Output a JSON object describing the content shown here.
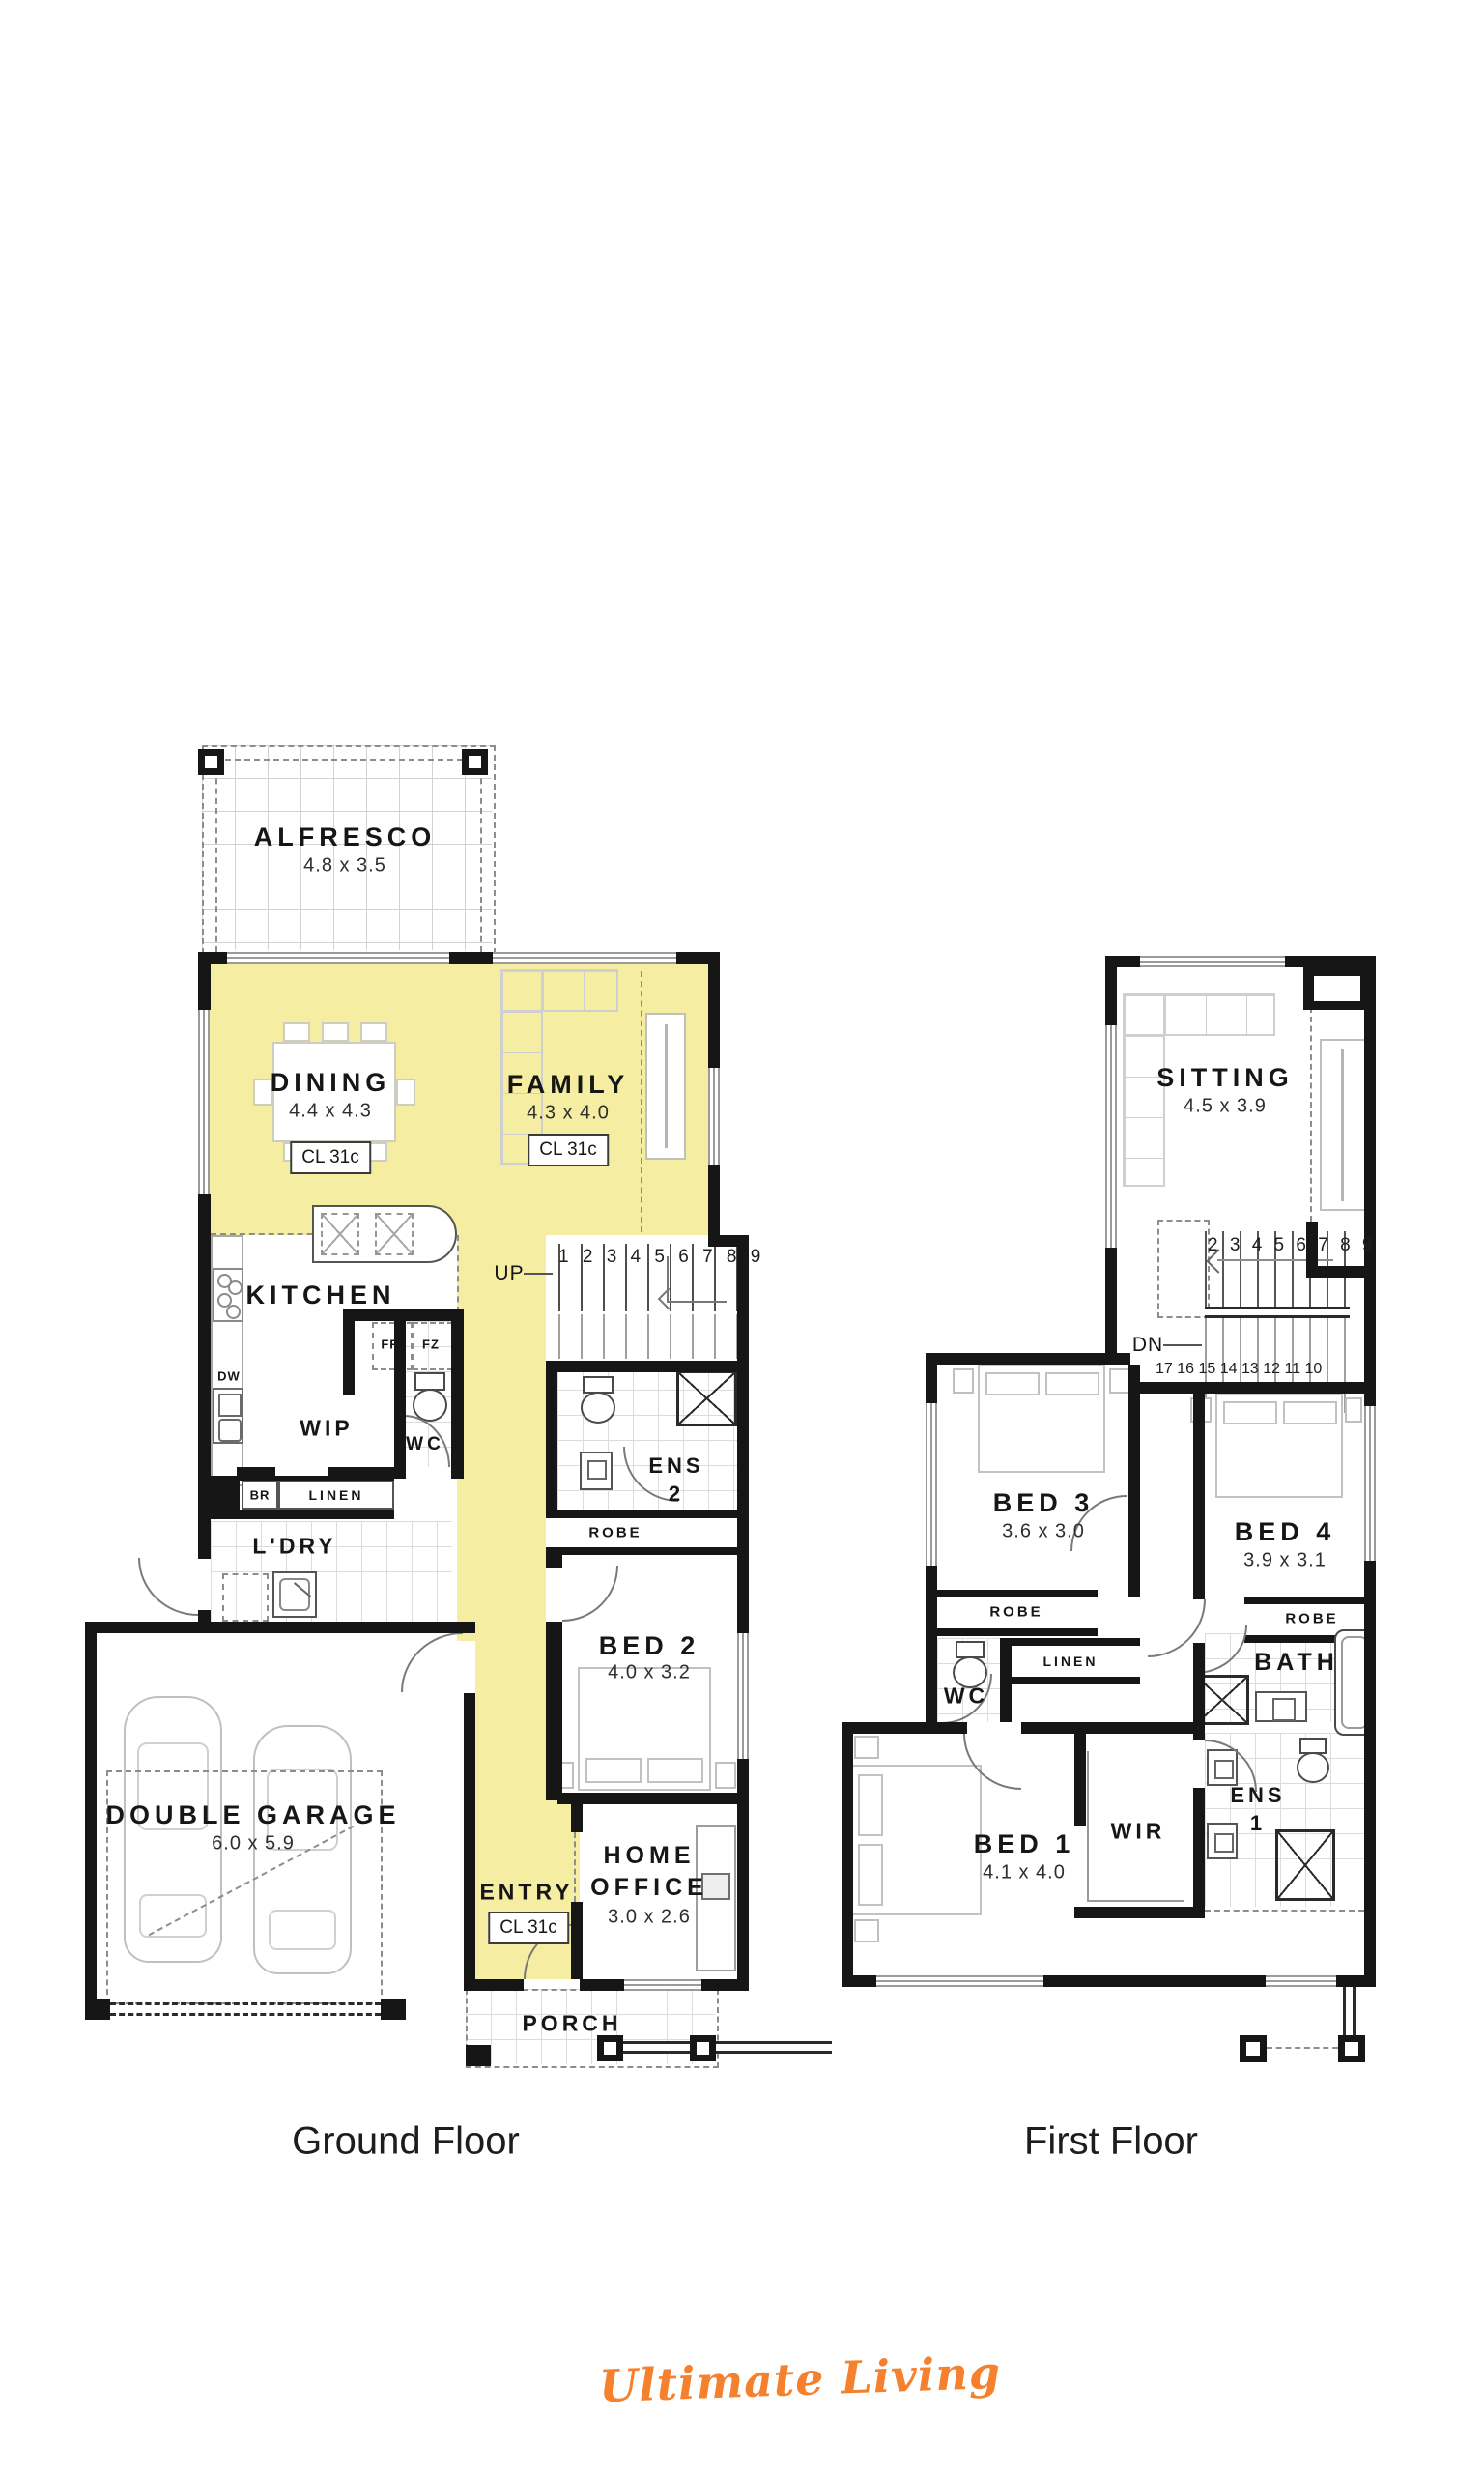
{
  "colors": {
    "highlight": "#F5EDA1",
    "accent_orange": "#F5812F",
    "wall": "#161616"
  },
  "brand": "Ultimate Living",
  "gf": {
    "caption": "Ground Floor",
    "alfresco": {
      "name": "ALFRESCO",
      "dims": "4.8 x 3.5"
    },
    "dining": {
      "name": "DINING",
      "dims": "4.4 x 4.3",
      "cl": "CL 31c"
    },
    "family": {
      "name": "FAMILY",
      "dims": "4.3 x 4.0",
      "cl": "CL 31c"
    },
    "kitchen": {
      "name": "KITCHEN"
    },
    "wip": {
      "name": "WIP"
    },
    "wc": {
      "name": "WC"
    },
    "ldry": {
      "name": "L'DRY"
    },
    "ens2": {
      "l1": "ENS",
      "l2": "2"
    },
    "robe": {
      "name": "ROBE"
    },
    "bed2": {
      "name": "BED 2",
      "dims": "4.0 x 3.2"
    },
    "garage": {
      "name": "DOUBLE GARAGE",
      "dims": "6.0 x 5.9"
    },
    "entry": {
      "name": "ENTRY",
      "cl": "CL 31c"
    },
    "office": {
      "l1": "HOME",
      "l2": "OFFICE",
      "dims": "3.0 x 2.6"
    },
    "porch": {
      "name": "PORCH"
    },
    "labels": {
      "up": "UP",
      "fr": "FR",
      "fz": "FZ",
      "dw": "DW",
      "br": "BR",
      "linen": "LINEN"
    },
    "stairs": {
      "run1": "1 2 3 4 5 6 7 8 9"
    }
  },
  "ff": {
    "caption": "First Floor",
    "sitting": {
      "name": "SITTING",
      "dims": "4.5 x 3.9"
    },
    "bed3": {
      "name": "BED 3",
      "dims": "3.6 x 3.0"
    },
    "bed4": {
      "name": "BED 4",
      "dims": "3.9 x 3.1"
    },
    "robe3": {
      "name": "ROBE"
    },
    "robe4": {
      "name": "ROBE"
    },
    "linen": {
      "name": "LINEN"
    },
    "wc": {
      "name": "WC"
    },
    "bath": {
      "name": "BATH"
    },
    "bed1": {
      "name": "BED 1",
      "dims": "4.1 x 4.0"
    },
    "wir": {
      "name": "WIR"
    },
    "ens1": {
      "l1": "ENS",
      "l2": "1"
    },
    "labels": {
      "dn": "DN"
    },
    "stairs": {
      "run_upper": "2 3 4 5 6 7 8 9",
      "run_lower": "17 16 15 14 13 12 11 10"
    }
  }
}
